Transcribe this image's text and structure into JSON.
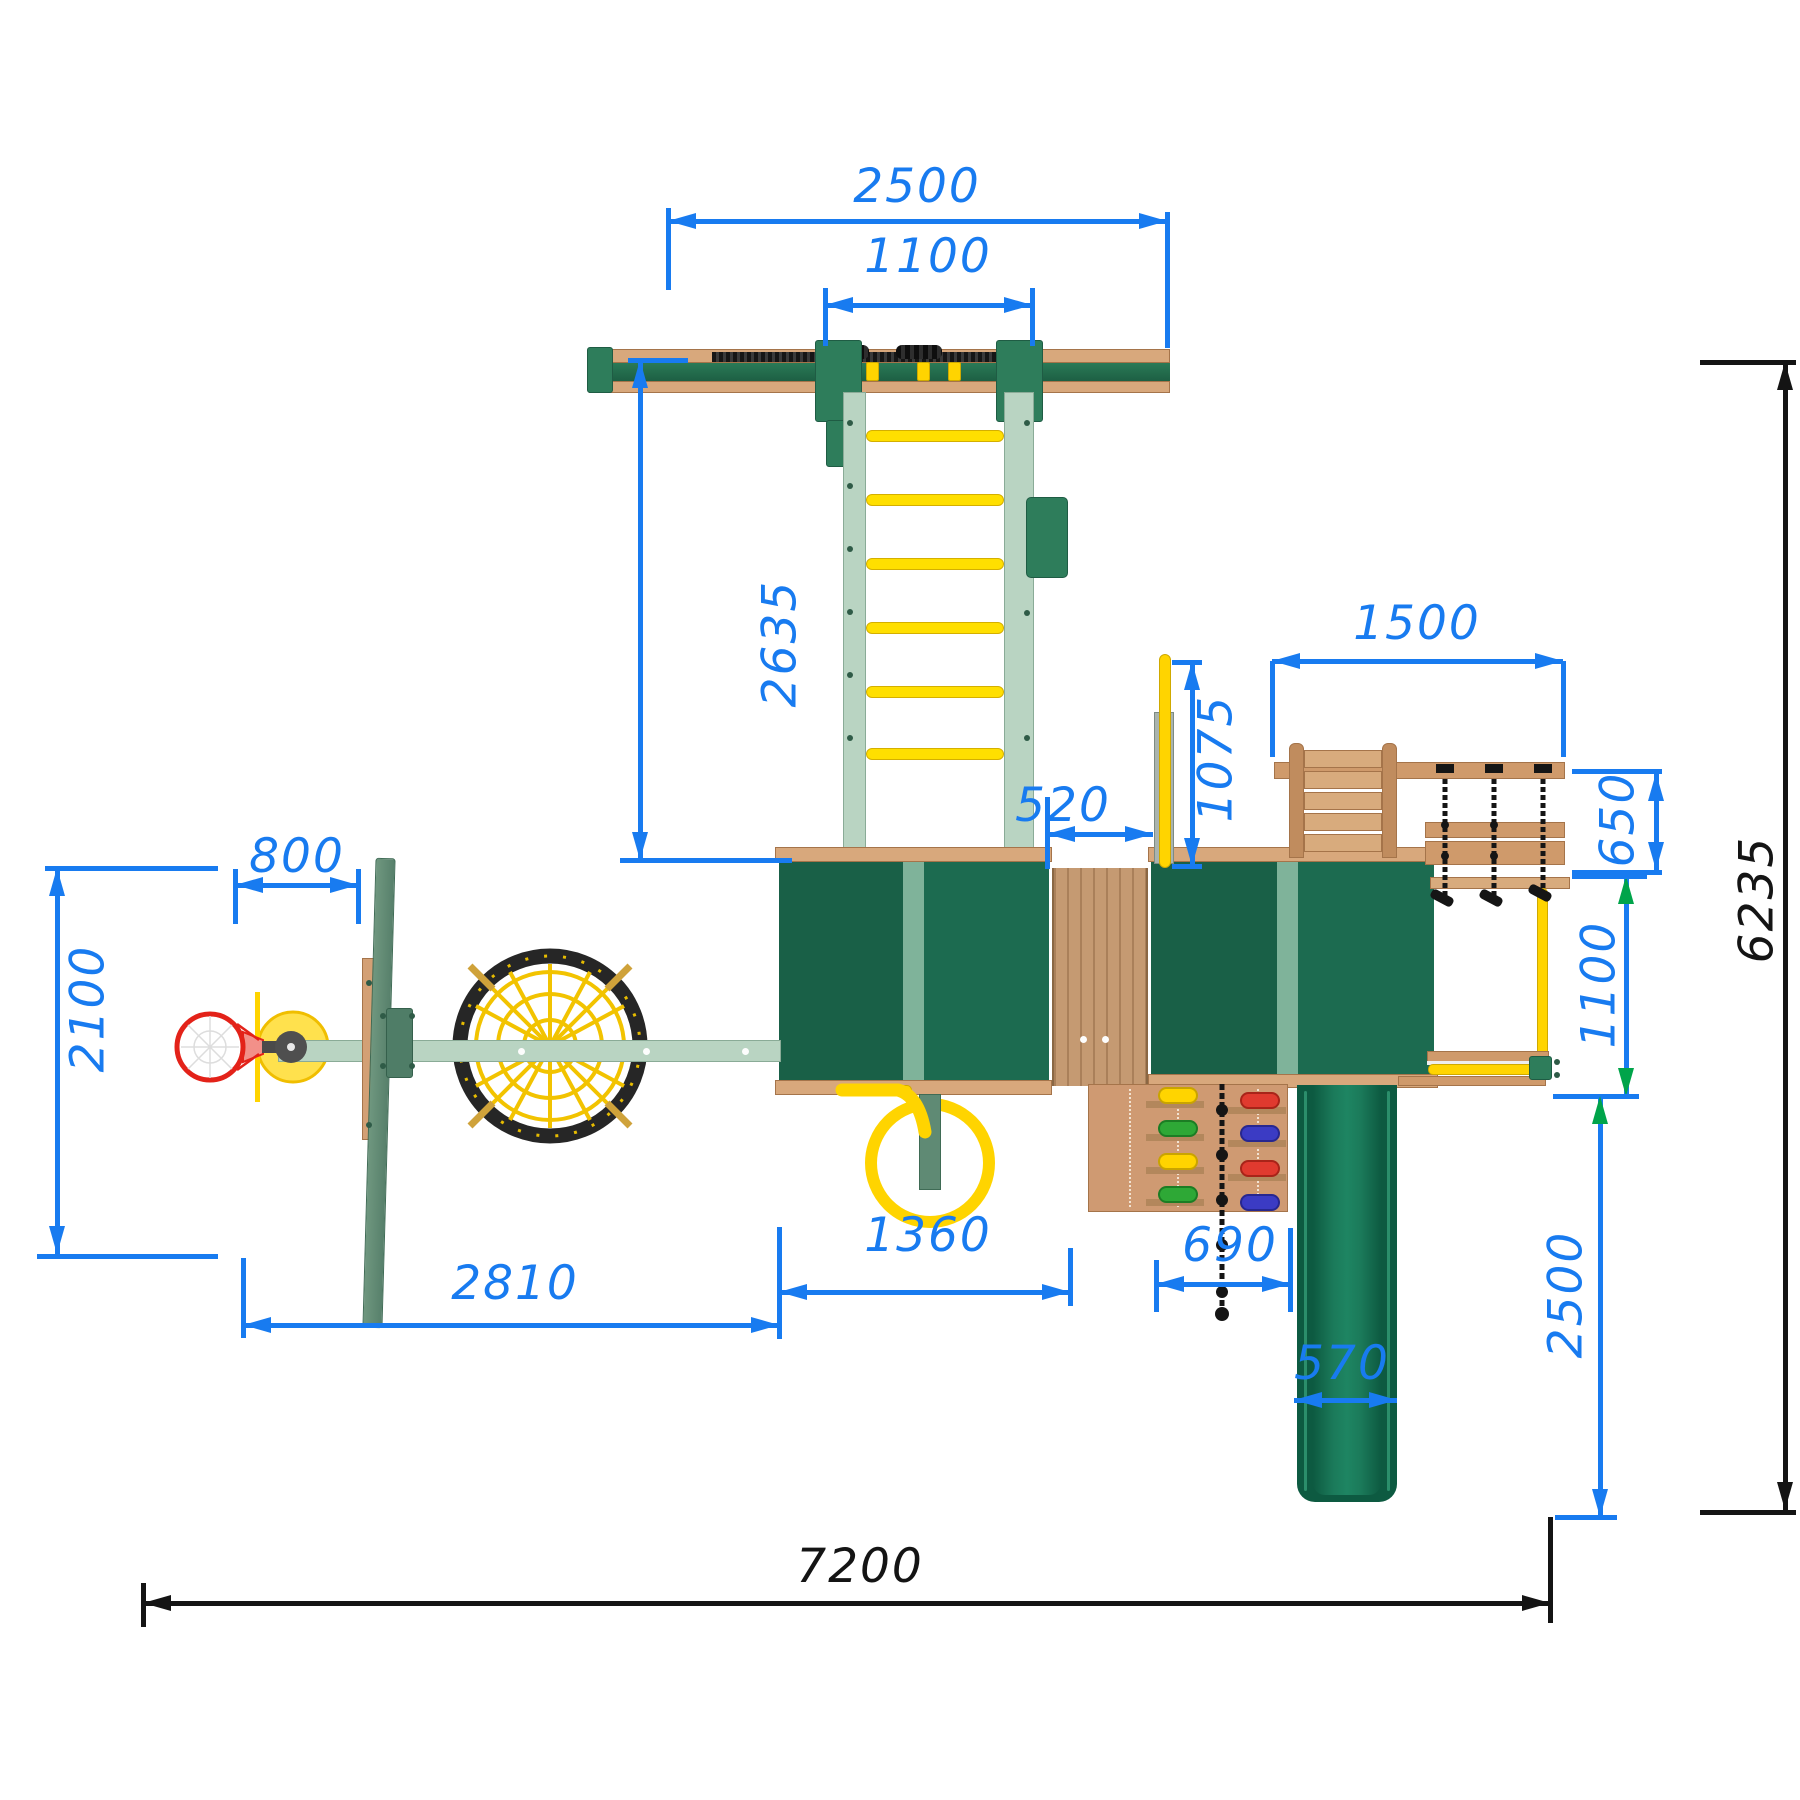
{
  "drawing": {
    "units": "mm",
    "view": "playground top view plan",
    "colors": {
      "dimension_blue": "#187BF0",
      "dimension_black": "#141414",
      "arrow_green": "#00A44A",
      "roof_green": "#1C6B50",
      "roof_ridge_green": "#7FB39A",
      "slide_green": "#0D5A41",
      "wood_tan": "#D8A87C",
      "frame_light_green": "#B9D4C2",
      "post_green": "#2E7D5B",
      "accent_yellow": "#FFD400",
      "hoop_red": "#E32219"
    },
    "dims": {
      "swing_beam": "2500",
      "swing_bay": "1100",
      "monkey_ladder": "2635",
      "hoop_offset": "800",
      "hoop_zone": "2100",
      "left_zone": "2810",
      "tower_width": "1360",
      "bridge_gap": "520",
      "fireman_pole": "1075",
      "side_module": "1500",
      "rope_bench": "650",
      "monkey_rail": "1100",
      "climb_wall": "690",
      "slide_width": "570",
      "slide_zone": "2500",
      "total_depth": "6235",
      "total_width": "7200"
    }
  }
}
